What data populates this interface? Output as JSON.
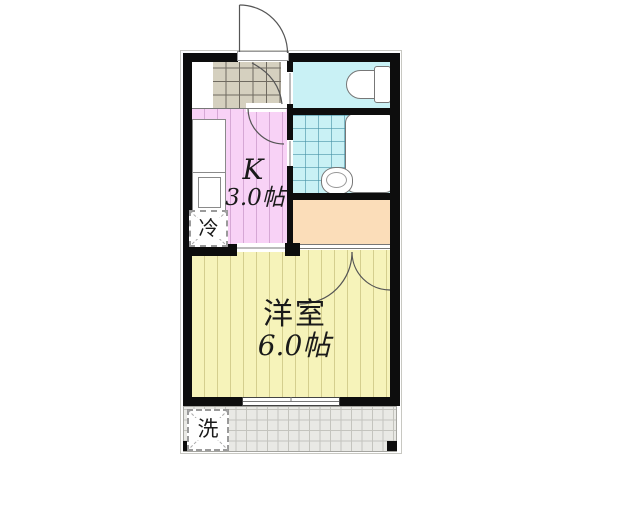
{
  "rooms": {
    "kitchen": {
      "label": "K",
      "size": "3.0帖",
      "color": "#f8d2f6"
    },
    "western_room": {
      "label": "洋室",
      "size": "6.0帖",
      "color": "#f6f3ba"
    },
    "closet": {
      "color": "#fbddb9"
    },
    "toilet": {
      "color": "#c9f1f5"
    },
    "bathroom": {
      "color": "#c9f1f5"
    },
    "entry": {
      "tile_color": "#d5d0bf"
    },
    "balcony": {
      "color": "#e9e9e5"
    }
  },
  "appliances": {
    "refrigerator": "冷",
    "washing_machine": "洗"
  },
  "fixtures": [
    "entrance-door",
    "toilet",
    "bathtub",
    "wash-basin",
    "kitchen-counter",
    "kitchen-sink"
  ],
  "wall_color": "#0d0d0d"
}
